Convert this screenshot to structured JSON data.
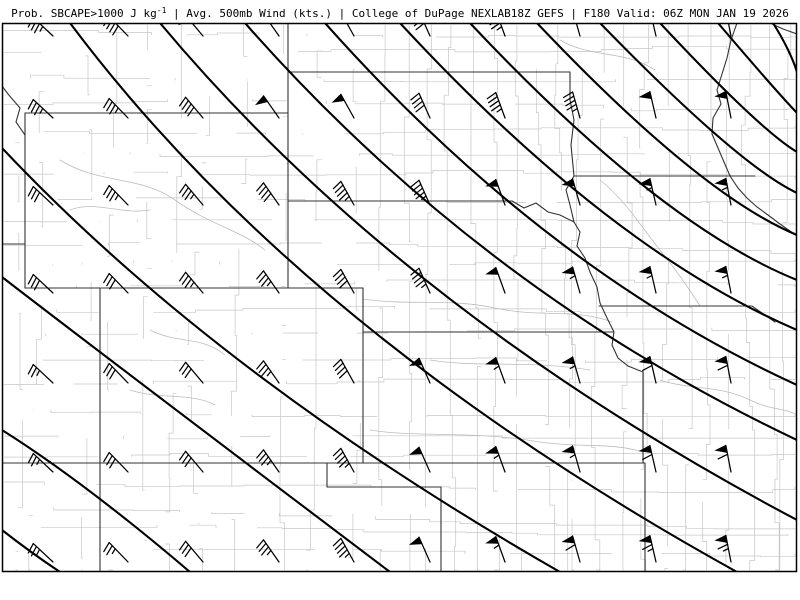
{
  "header": {
    "title_prefix": "Prob. SBCAPE>1000 J kg",
    "title_sup": "-1",
    "title_rest": " | Avg. 500mb Wind (kts.) | College of DuPage NEXLAB18Z GEFS | F180 Valid: 06Z MON JAN 19 2026",
    "fields": {
      "probability_field": "Prob. SBCAPE>1000 J kg-1",
      "wind_field": "Avg. 500mb Wind (kts.)",
      "source": "College of DuPage NEXLAB",
      "model_run": "18Z GEFS",
      "forecast_hour": "F180",
      "valid_time": "06Z MON JAN 19 2026"
    }
  },
  "map": {
    "frame": {
      "x": 2.5,
      "y": 23.5,
      "w": 794,
      "h": 548
    },
    "colors": {
      "background": "#ffffff",
      "frame": "#000000",
      "contour": "#000000",
      "state": "#333333",
      "river_dark": "#333333",
      "county": "#c7c7c7",
      "river_light": "#bdbdbd",
      "barb": "#000000"
    },
    "contours": [
      "M2,530 Q30,552 60,572",
      "M2,430 Q83,481 190,572",
      "M2,277 Q90,345 390,572",
      "M2,148 Q216,375 560,572",
      "M70,23 Q300,330 737,572",
      "M160,23 Q400,310 797,520",
      "M245,23 Q480,290 797,440",
      "M325,23 Q545,270 797,385",
      "M400,23 Q610,250 797,330",
      "M470,23 Q660,225 797,280",
      "M537,23 Q700,195 797,235",
      "M600,23 Q738,165 797,193",
      "M660,23 Q760,130 797,152",
      "M718,23 Q775,90 797,113",
      "M773,23 Q790,50 797,72"
    ],
    "state_lines": [
      "M25,113 L288,113 L288,288 L25,288 L25,113",
      "M288,23 L288,113",
      "M288,72 L570,72",
      "M570,72 L570,100 L574,120 L571,145 L574,176",
      "M574,176 L755,176",
      "M574,176 L566,190 L570,205 L574,222",
      "M288,201 L512,201",
      "M100,288 L363,288 L363,463 L100,463 L100,288",
      "M25,288 L100,288",
      "M2,244 L25,244",
      "M363,332 L614,332",
      "M2,463 L645,463",
      "M327,463 L327,487 L441,487 L441,572",
      "M100,463 L100,572",
      "M643,372 L643,463",
      "M645,463 L645,572",
      "M599,306 L752,306 L775,322",
      "M25,135 L16,122 L20,108 L8,94 L2,86"
    ],
    "rivers_dark": [
      "M512,201 L524,208 L536,203 L548,212 L560,215 L574,222 L580,232 L577,246 L585,258 L590,272 L597,287 L600,303 L607,318 L614,332 L612,345 L618,358 L628,366 L643,372",
      "M737,23 L731,40 L727,58 L722,74 L717,90 L721,104 L713,118 L712,134 L718,148 L724,162 L730,176 L738,188 L747,198 L757,207 L768,215 L780,224 L790,231 L797,236",
      "M770,23 L783,29 L797,34"
    ],
    "rivers_light": [
      "M363,299 C410,306 450,298 495,308 C540,318 575,308 612,322",
      "M60,160 C100,185 140,175 175,200 C210,225 240,230 265,250",
      "M70,210 C95,200 120,215 150,210",
      "M430,360 C480,368 530,360 590,370",
      "M370,430 C420,438 470,430 540,442 C580,448 610,442 643,452",
      "M600,180 C625,200 640,225 660,250 C680,275 690,290 700,306",
      "M660,380 C690,390 720,385 750,400 C770,410 785,408 797,415",
      "M560,40 C590,58 625,50 655,70",
      "M150,330 C180,345 200,335 225,355",
      "M130,390 C160,400 190,392 215,405"
    ],
    "county_grid": {
      "seed": 11,
      "east_boundary_x": 365,
      "east_step": 21,
      "west_step": 34
    },
    "wind_barbs": {
      "units": "kts",
      "cols_x": [
        53,
        128,
        203,
        279,
        354,
        430,
        505,
        580,
        656,
        731
      ],
      "rows_y": [
        36,
        118,
        205,
        293,
        383,
        472,
        562
      ],
      "dirs_from_by_col": [
        313,
        316,
        320,
        325,
        331,
        336,
        340,
        344,
        347,
        349
      ],
      "speeds": [
        [
          35,
          40,
          50,
          50,
          50,
          40,
          45,
          50,
          50,
          50
        ],
        [
          35,
          35,
          40,
          50,
          50,
          40,
          45,
          45,
          50,
          50
        ],
        [
          30,
          35,
          35,
          40,
          45,
          45,
          50,
          50,
          55,
          55
        ],
        [
          30,
          30,
          35,
          35,
          40,
          45,
          50,
          55,
          55,
          55
        ],
        [
          25,
          30,
          30,
          35,
          40,
          50,
          55,
          55,
          60,
          60
        ],
        [
          25,
          30,
          30,
          35,
          45,
          50,
          55,
          55,
          60,
          60
        ],
        [
          25,
          25,
          30,
          35,
          45,
          50,
          55,
          60,
          65,
          65
        ]
      ],
      "shaft_len": 27
    }
  }
}
